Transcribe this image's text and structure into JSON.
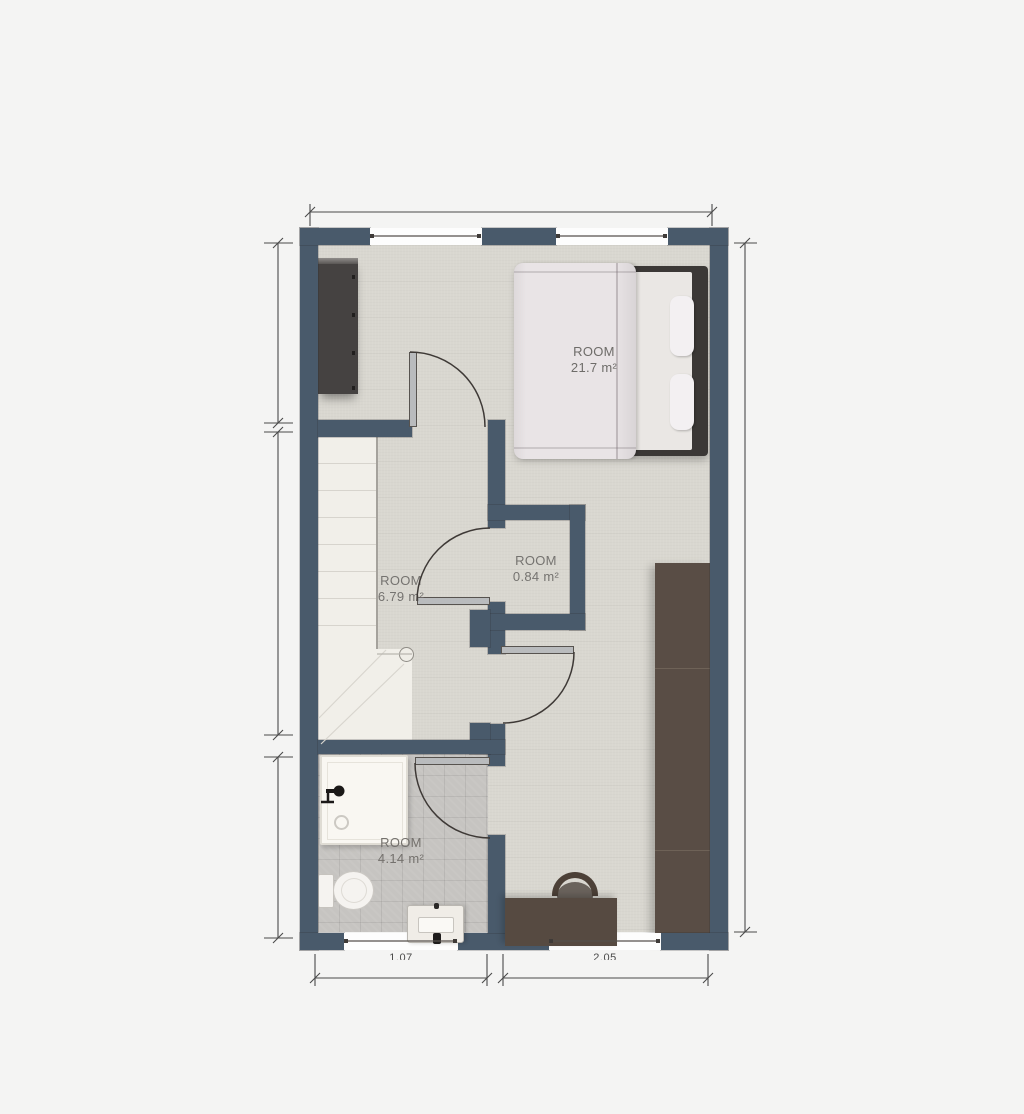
{
  "floor_plan": {
    "rooms": [
      {
        "label": "ROOM",
        "area": "21.7 m²"
      },
      {
        "label": "ROOM",
        "area": "6.79 m²"
      },
      {
        "label": "ROOM",
        "area": "0.84 m²"
      },
      {
        "label": "ROOM",
        "area": "4.14 m²"
      }
    ],
    "dimension_labels": {
      "bottom_left_window": "1.07",
      "bottom_right_window": "2.05"
    },
    "colors": {
      "wall": "#495a6b",
      "carpet_floor": "#d9d7d0",
      "tile_floor": "#c6c4c1",
      "page_background": "#f4f4f3",
      "dark_furniture": "#564a41",
      "door_arc": "#3e3936"
    },
    "fixtures": [
      "wardrobe",
      "double-bed",
      "stairs",
      "closet",
      "shower",
      "toilet",
      "sink-vanity",
      "desk",
      "chair",
      "tall-wardrobe"
    ]
  }
}
